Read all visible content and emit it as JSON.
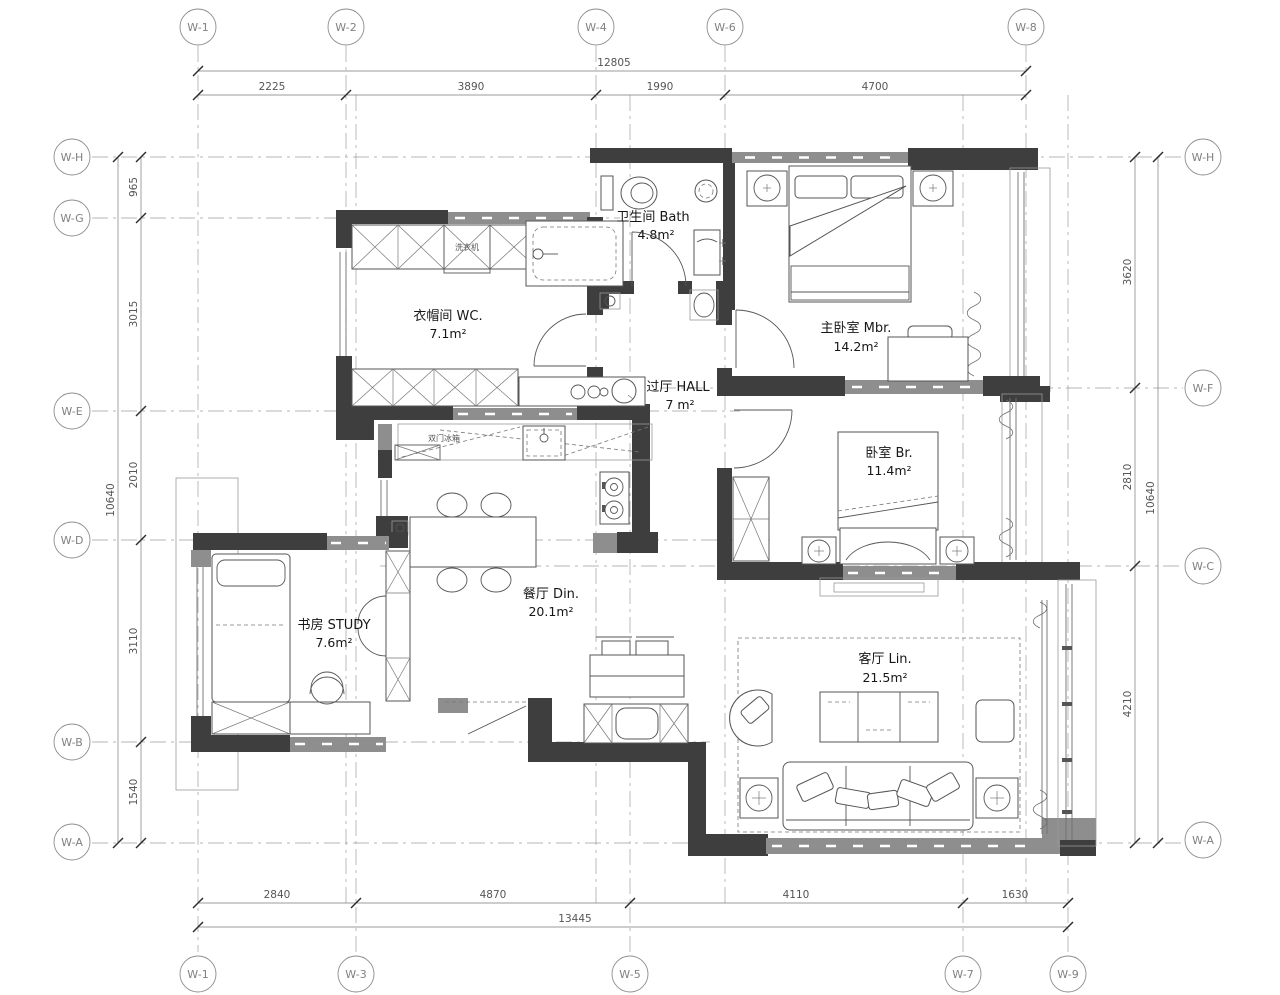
{
  "plan": {
    "rooms": [
      {
        "id": "bath",
        "label": "卫生间 Bath",
        "area": "4.8m²"
      },
      {
        "id": "mbr",
        "label": "主卧室 Mbr.",
        "area": "14.2m²"
      },
      {
        "id": "wc",
        "label": "衣帽间 WC.",
        "area": "7.1m²"
      },
      {
        "id": "hall",
        "label": "过厅 HALL",
        "area": "7 m²"
      },
      {
        "id": "br",
        "label": "卧室 Br.",
        "area": "11.4m²"
      },
      {
        "id": "din",
        "label": "餐厅 Din.",
        "area": "20.1m²"
      },
      {
        "id": "study",
        "label": "书房 STUDY",
        "area": "7.6m²"
      },
      {
        "id": "lin",
        "label": "客厅 Lin.",
        "area": "21.5m²"
      }
    ],
    "appliances": {
      "washer": "洗衣机",
      "fridge": "双门冰箱"
    },
    "wall_colors": {
      "structural": "#3e3e3e",
      "infill": "#8e8e8e"
    }
  },
  "grid": {
    "top": [
      "W-1",
      "W-2",
      "W-4",
      "W-6",
      "W-8"
    ],
    "bottom": [
      "W-1",
      "W-3",
      "W-5",
      "W-7",
      "W-9"
    ],
    "left": [
      "W-H",
      "W-G",
      "W-E",
      "W-D",
      "W-B",
      "W-A"
    ],
    "right": [
      "W-H",
      "W-F",
      "W-C",
      "W-A"
    ]
  },
  "dims": {
    "top": {
      "overall": "12805",
      "segments": [
        "2225",
        "3890",
        "1990",
        "4700"
      ]
    },
    "bottom": {
      "overall": "13445",
      "segments": [
        "2840",
        "4870",
        "4110",
        "1630"
      ]
    },
    "left": {
      "overall": "10640",
      "segments": [
        "965",
        "3015",
        "2010",
        "3110",
        "1540"
      ]
    },
    "right": {
      "overall": "10640",
      "segments": [
        "3620",
        "2810",
        "4210"
      ]
    }
  }
}
